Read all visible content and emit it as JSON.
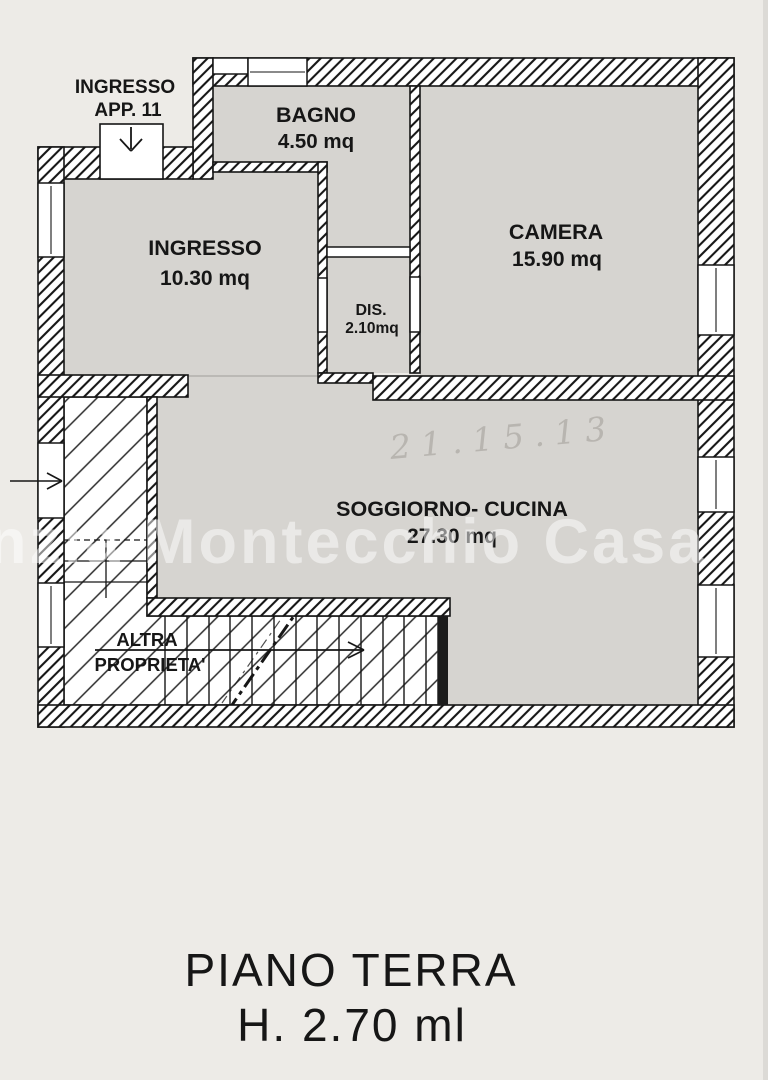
{
  "colors": {
    "paper": "#edebe7",
    "room_fill": "#d6d4d0",
    "ink": "#161616",
    "watermark_color": "#ffffff"
  },
  "plan": {
    "entrance": {
      "line1": "INGRESSO",
      "line2": "APP. 11"
    },
    "rooms": [
      {
        "name": "INGRESSO",
        "area": "10.30 mq"
      },
      {
        "name": "BAGNO",
        "area": "4.50 mq"
      },
      {
        "name": "CAMERA",
        "area": "15.90 mq"
      },
      {
        "name": "DIS.",
        "area": "2.10mq"
      },
      {
        "name": "SOGGIORNO- CUCINA",
        "area": "27.30 mq"
      }
    ],
    "other_property": {
      "line1": "ALTRA",
      "line2": "PROPRIETA'"
    },
    "handwritten_note": "21.15.13",
    "watermark": "Agenzia Montecchio Casa"
  },
  "caption": {
    "line1": "PIANO TERRA",
    "line2": "H. 2.70 ml"
  }
}
